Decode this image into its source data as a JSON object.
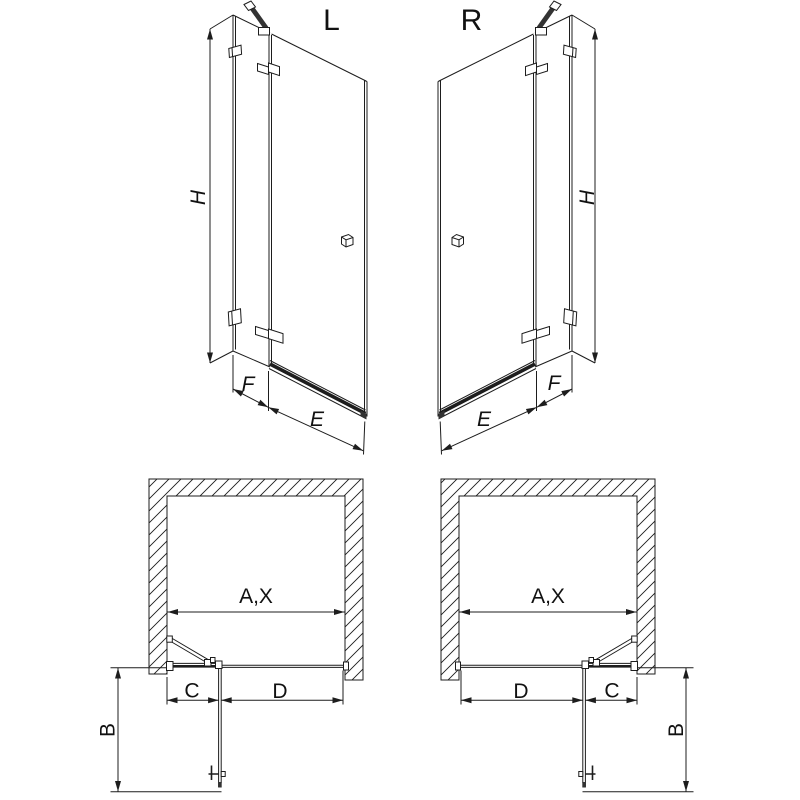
{
  "canvas": {
    "background": "#ffffff",
    "line_color": "#1d1d1d"
  },
  "views": {
    "left_3d": {
      "label": "L",
      "height_dim": "H",
      "fixed_panel_dim": "F",
      "door_dim": "E"
    },
    "right_3d": {
      "label": "R",
      "height_dim": "H",
      "fixed_panel_dim": "F",
      "door_dim": "E"
    },
    "left_plan": {
      "opening_dim": "A,X",
      "fixed_panel_dim": "C",
      "door_dim": "D",
      "swing_depth_dim": "B"
    },
    "right_plan": {
      "opening_dim": "A,X",
      "fixed_panel_dim": "C",
      "door_dim": "D",
      "swing_depth_dim": "B"
    }
  }
}
